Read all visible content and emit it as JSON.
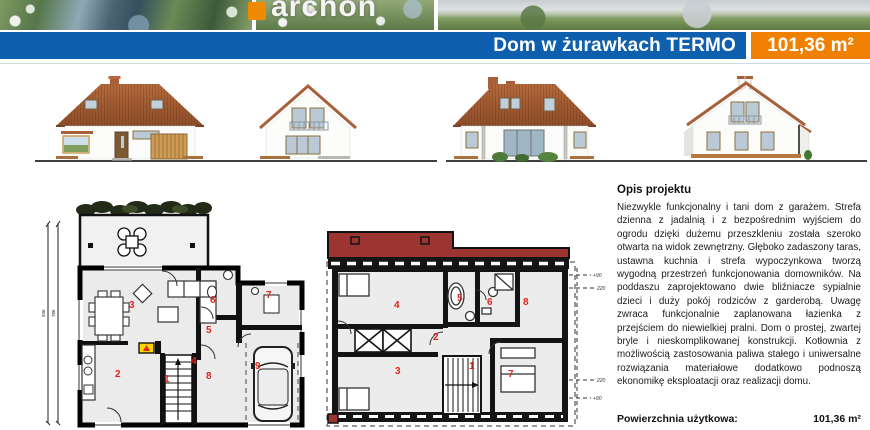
{
  "brand": {
    "logo_text": "archon",
    "accent_color": "#f08a00"
  },
  "header": {
    "title": "Dom w żurawkach TERMO",
    "area_badge": "101,36 m²",
    "bar_color": "#0e5fae",
    "badge_color": "#f08000"
  },
  "plans": {
    "ground_floor": {
      "room_numbers": [
        "1",
        "2",
        "3",
        "4",
        "5",
        "6",
        "7",
        "8",
        "9"
      ],
      "dimensions": [
        "936",
        "786"
      ],
      "accent_red": "#e0261d",
      "stove_yellow": "#ffd400"
    },
    "attic": {
      "room_numbers": [
        "1",
        "2",
        "3",
        "4",
        "5",
        "6",
        "7",
        "8"
      ],
      "height_marks": [
        "+90",
        "220",
        "220",
        "+90"
      ],
      "roof_band_color": "#9c3531"
    }
  },
  "description": {
    "heading": "Opis projektu",
    "body": "Niezwykle funkcjonalny i tani dom z garażem. Strefa dzienna z jadalnią i z bezpośrednim wyjściem do ogrodu dzięki dużemu przeszkleniu została szeroko otwarta na widok zewnętrzny. Głęboko zadaszony taras, ustawna kuchnia i strefa wypoczynkowa tworzą wygodną przestrzeń funkcjonowania domowników. Na poddaszu zaprojektowano dwie bliźniacze sypialnie dzieci i duży pokój rodziców z garderobą. Uwagę zwraca funkcjonalnie zaplanowana łazienka z przejściem do niewielkiej pralni. Dom o prostej, zwartej bryle i nieskomplikowanej konstrukcji. Kotłownia z możliwością zastosowania paliwa stałego i uniwersalne rozwiązania materiałowe dodatkowo podnoszą ekonomikę eksploatacji oraz realizacji domu.",
    "area_label": "Powierzchnia użytkowa:",
    "area_value": "101,36 m²"
  }
}
